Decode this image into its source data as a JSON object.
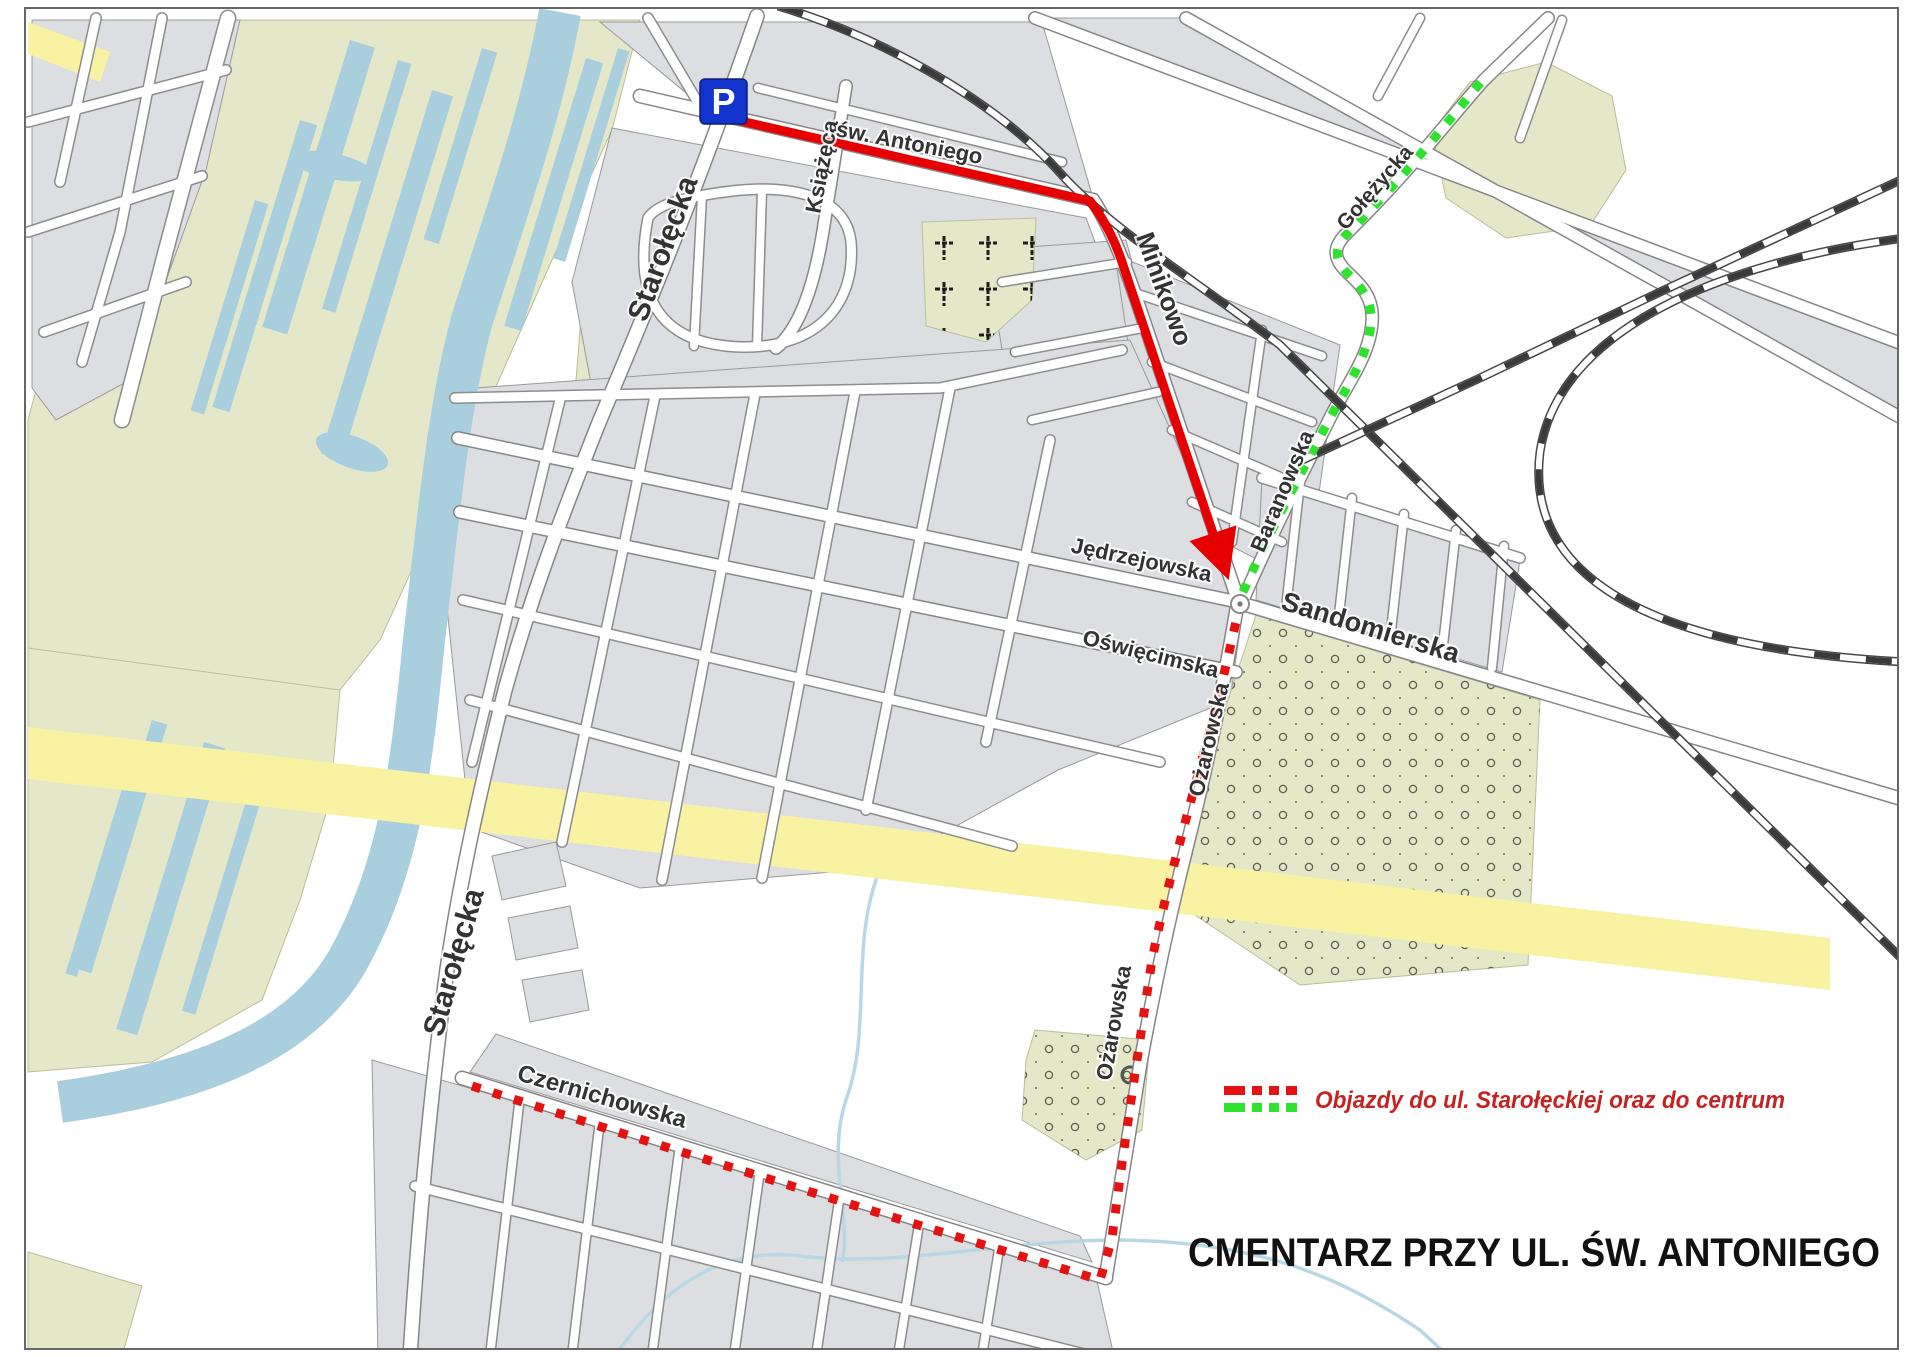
{
  "title": {
    "text": "CMENTARZ PRZY UL. ŚW. ANTONIEGO"
  },
  "legend": {
    "label": "Objazdy do ul. Starołęckiej oraz do centrum",
    "red_swatch": "#e51212",
    "green_swatch": "#2ee22e",
    "text_color": "#c42323"
  },
  "parking": {
    "letter": "P",
    "bg": "#1233cc"
  },
  "colors": {
    "route_red": "#e60000",
    "route_green": "#2ee22e",
    "water": "#a9cede",
    "stream": "#b9d8e6",
    "highway": "#f8f2a2",
    "land": "#e4e8c9",
    "block": "#dcdee1",
    "rail": "#3a3a3a",
    "title_color": "#111111"
  },
  "streets": {
    "starolecka_upper": "Starołęcka",
    "starolecka_lower": "Starołęcka",
    "ksiazeca": "Książęca",
    "sw_antoniego": "św. Antoniego",
    "minikowo": "Minikowo",
    "golezycka": "Gołężycka",
    "baranowska": "Baranowska",
    "sandomierska": "Sandomierska",
    "jedrzejowska": "Jędrzejowska",
    "oswiecimska": "Oświęcimska",
    "ozarowska_upper": "Ożarowska",
    "ozarowska_lower": "Ożarowska",
    "czernichowska": "Czernichowska"
  }
}
